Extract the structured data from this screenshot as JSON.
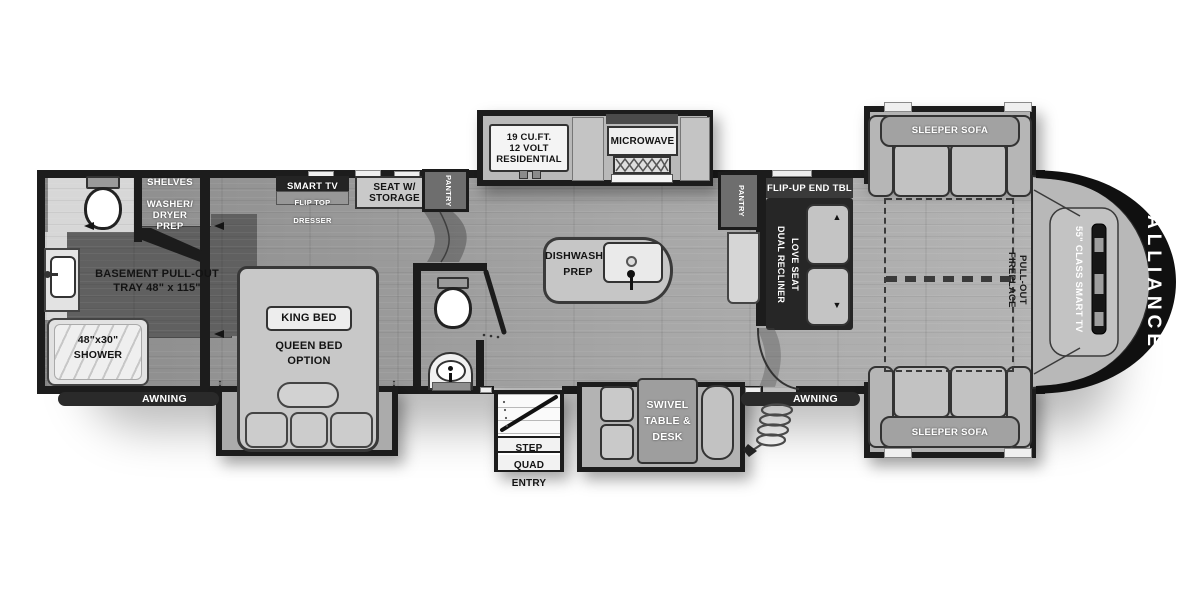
{
  "floorplan": {
    "brand": "ALLIANCE",
    "rear_bath": {
      "shelves": "SHELVES",
      "washer_line1": "WASHER/",
      "washer_line2": "DRYER PREP",
      "basement_line1": "BASEMENT PULL-OUT",
      "basement_line2": "TRAY 48\" x 115\"",
      "shower_line1": "48\"x30\"",
      "shower_line2": "SHOWER"
    },
    "bedroom": {
      "smart_tv": "SMART TV",
      "flip_top_dresser": "FLIP TOP DRESSER",
      "seat_line1": "SEAT W/",
      "seat_line2": "STORAGE",
      "pantry": "PANTRY",
      "king_bed": "KING BED",
      "queen_line1": "QUEEN BED",
      "queen_line2": "OPTION",
      "slide_marker": "↕"
    },
    "kitchen": {
      "fridge_line1": "19 CU.FT.",
      "fridge_line2": "12 VOLT",
      "fridge_line3": "RESIDENTIAL",
      "microwave": "MICROWAVE",
      "island_line1": "DISHWASHER",
      "island_line2": "PREP",
      "pantry": "PANTRY"
    },
    "living": {
      "flip_up_end_table": "FLIP-UP END TBL",
      "recliner_line1": "DUAL RECLINER",
      "recliner_line2": "LOVE SEAT",
      "recline_up": "▲",
      "recline_down": "▼",
      "sofa_top": "SLEEPER SOFA",
      "sofa_bottom": "SLEEPER SOFA",
      "fireplace_line1": "PULL-OUT FIREPLACE",
      "fireplace_line2": "STORAGE",
      "tv": "55\" CLASS SMART TV"
    },
    "dinette": {
      "line1": "SWIVEL",
      "line2": "TABLE &",
      "line3": "DESK"
    },
    "exterior": {
      "awning_left": "AWNING",
      "awning_right": "AWNING",
      "step_line1": "STEP ABOVE",
      "step_line2": "QUAD ENTRY"
    }
  },
  "colors": {
    "wall": "#1c1c1c",
    "tray_dark": "#606060",
    "nose_cap": "#101010"
  }
}
